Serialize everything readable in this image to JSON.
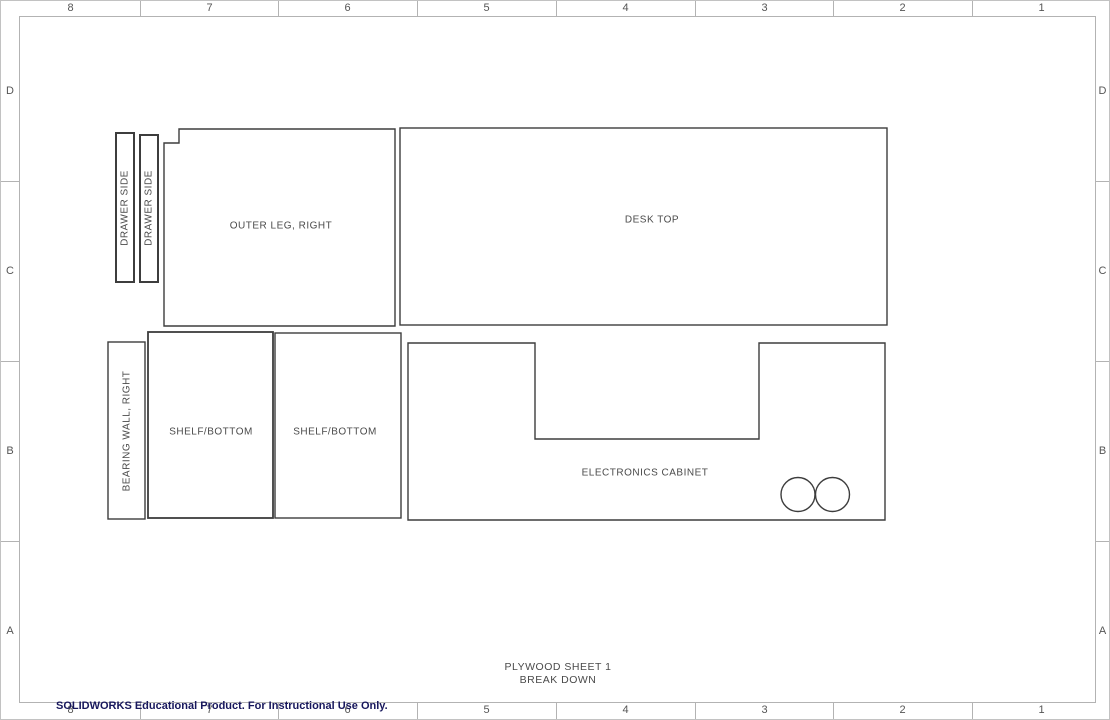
{
  "border": {
    "columns": [
      "8",
      "7",
      "6",
      "5",
      "4",
      "3",
      "2",
      "1"
    ],
    "rows": [
      "D",
      "C",
      "B",
      "A"
    ]
  },
  "parts": {
    "drawer_side_1": "DRAWER SIDE",
    "drawer_side_2": "DRAWER SIDE",
    "outer_leg_right": "OUTER LEG, RIGHT",
    "desk_top": "DESK TOP",
    "bearing_wall_right": "BEARING WALL, RIGHT",
    "shelf_bottom_1": "SHELF/BOTTOM",
    "shelf_bottom_2": "SHELF/BOTTOM",
    "electronics_cabinet": "ELECTRONICS CABINET"
  },
  "title": {
    "line1": "PLYWOOD SHEET 1",
    "line2": "BREAK DOWN"
  },
  "footer": "SOLIDWORKS Educational Product. For Instructional Use Only.",
  "colors": {
    "line": "#3d3d3d",
    "frame": "#b3b3b3",
    "label_text": "#4a4a4a",
    "footer_text": "#17175c"
  }
}
